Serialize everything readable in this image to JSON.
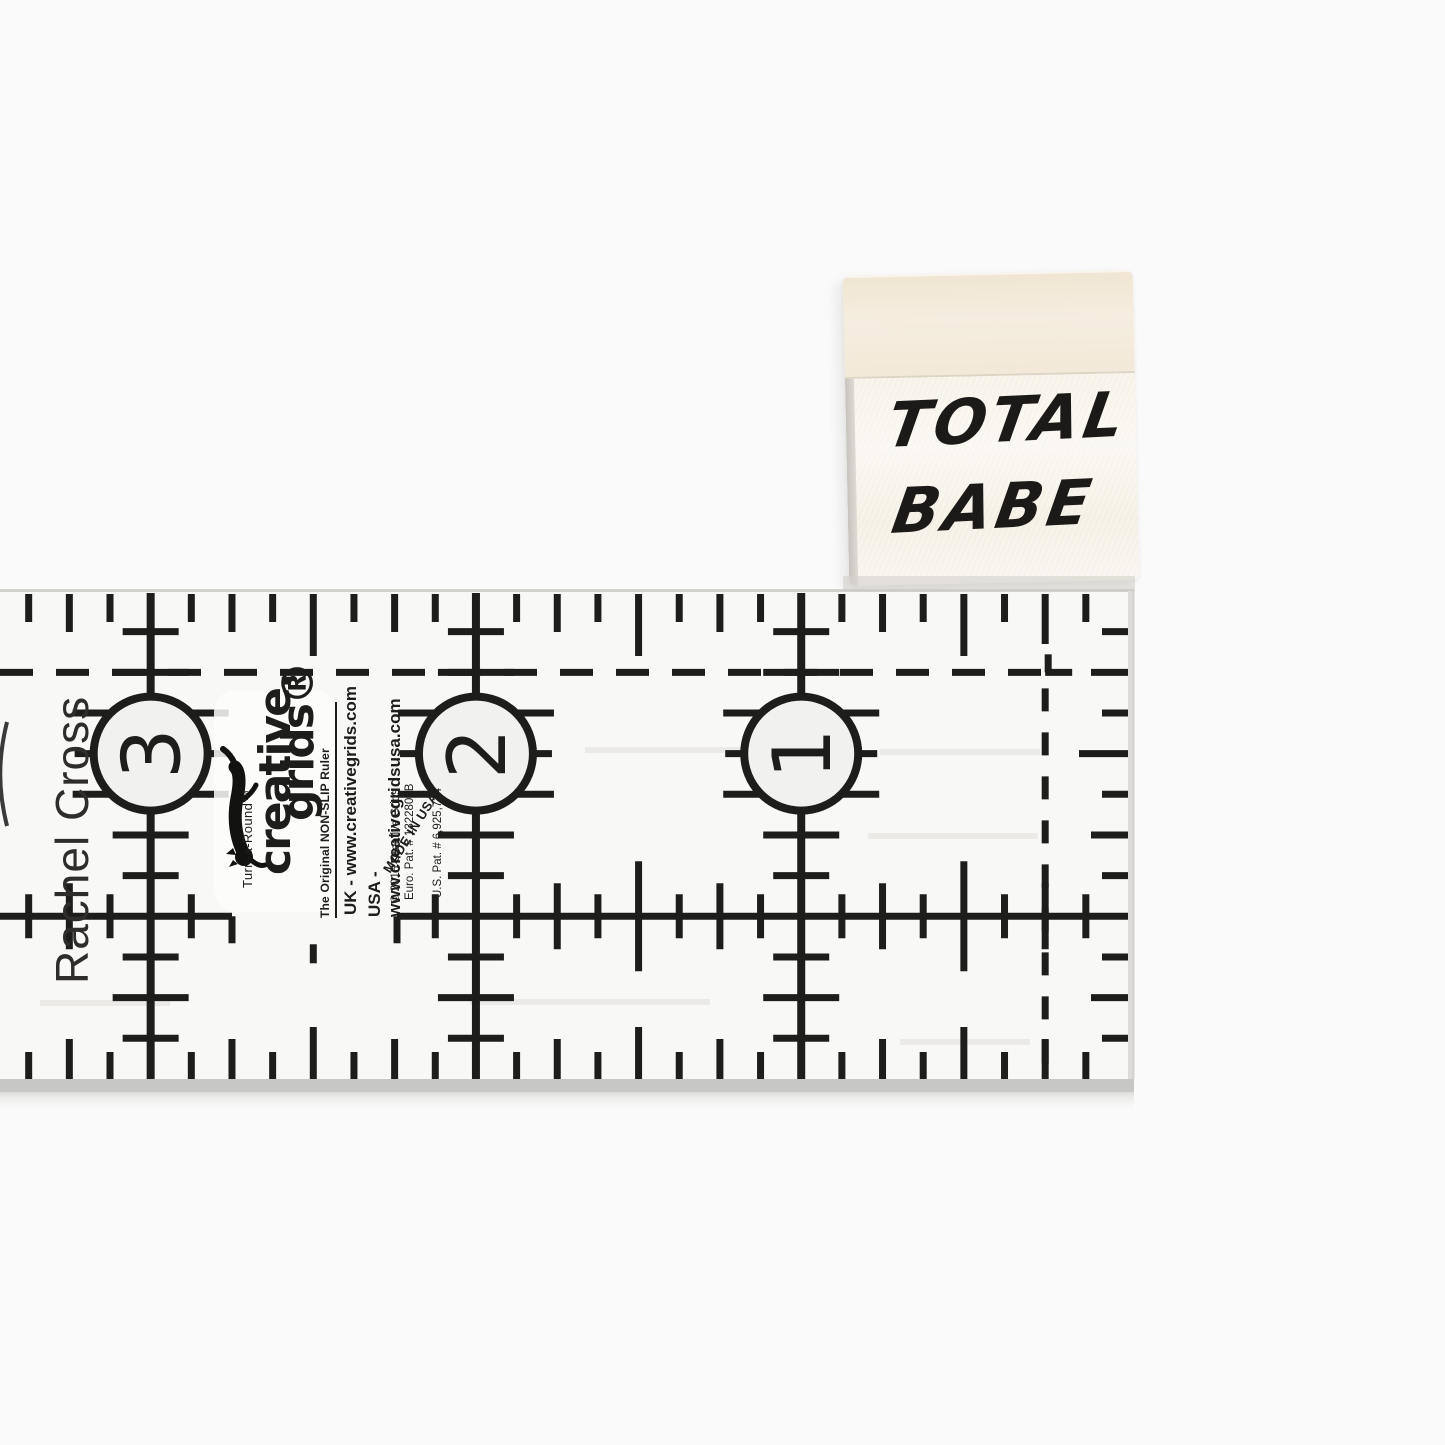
{
  "scene": {
    "background_color": "#fafafa",
    "description_icon": "photo-of-ruler-and-label"
  },
  "label": {
    "line1": "TOTAL",
    "line2": "BABE",
    "fold_color": "#f2e9da",
    "body_color": "#f8f5ee",
    "text_color": "#1c1a18"
  },
  "ruler": {
    "designer": "Rachel Cross",
    "brand": {
      "turnaround": "Turn-a-Round™",
      "logo_line1": "creative.",
      "logo_line2": "grids®",
      "cat_icon": "cat-logo-icon",
      "tagline": "The Original NON-SLIP Ruler",
      "url_uk": "UK - www.creativegrids.com",
      "url_usa": "USA - www.creativegridsusa.com",
      "copyright": "© 2015 Creative Grids",
      "euro_pat": "Euro. Pat. # 1322809B",
      "us_pat": "U.S. Pat. # 6,925,724",
      "made_in": "MADE IN USA"
    },
    "numbers": [
      {
        "value": "3",
        "col": 24
      },
      {
        "value": "2",
        "col": 16
      },
      {
        "value": "1",
        "col": 8
      }
    ],
    "geometry": {
      "top": 591,
      "bottom": 1079,
      "left": 0,
      "right_edge": 1131,
      "zero_x": 1126.5,
      "eighth": 40.66,
      "ink": "#1d1d1b",
      "circle_fill": "#f1f1ef",
      "circle_radius": 57,
      "h_gap_left": 232,
      "h_gap_right": 397,
      "body_fill": "#f8f8f7",
      "bottom_strip": "#c7c7c5",
      "edge_line": "#cbc9c5"
    }
  }
}
